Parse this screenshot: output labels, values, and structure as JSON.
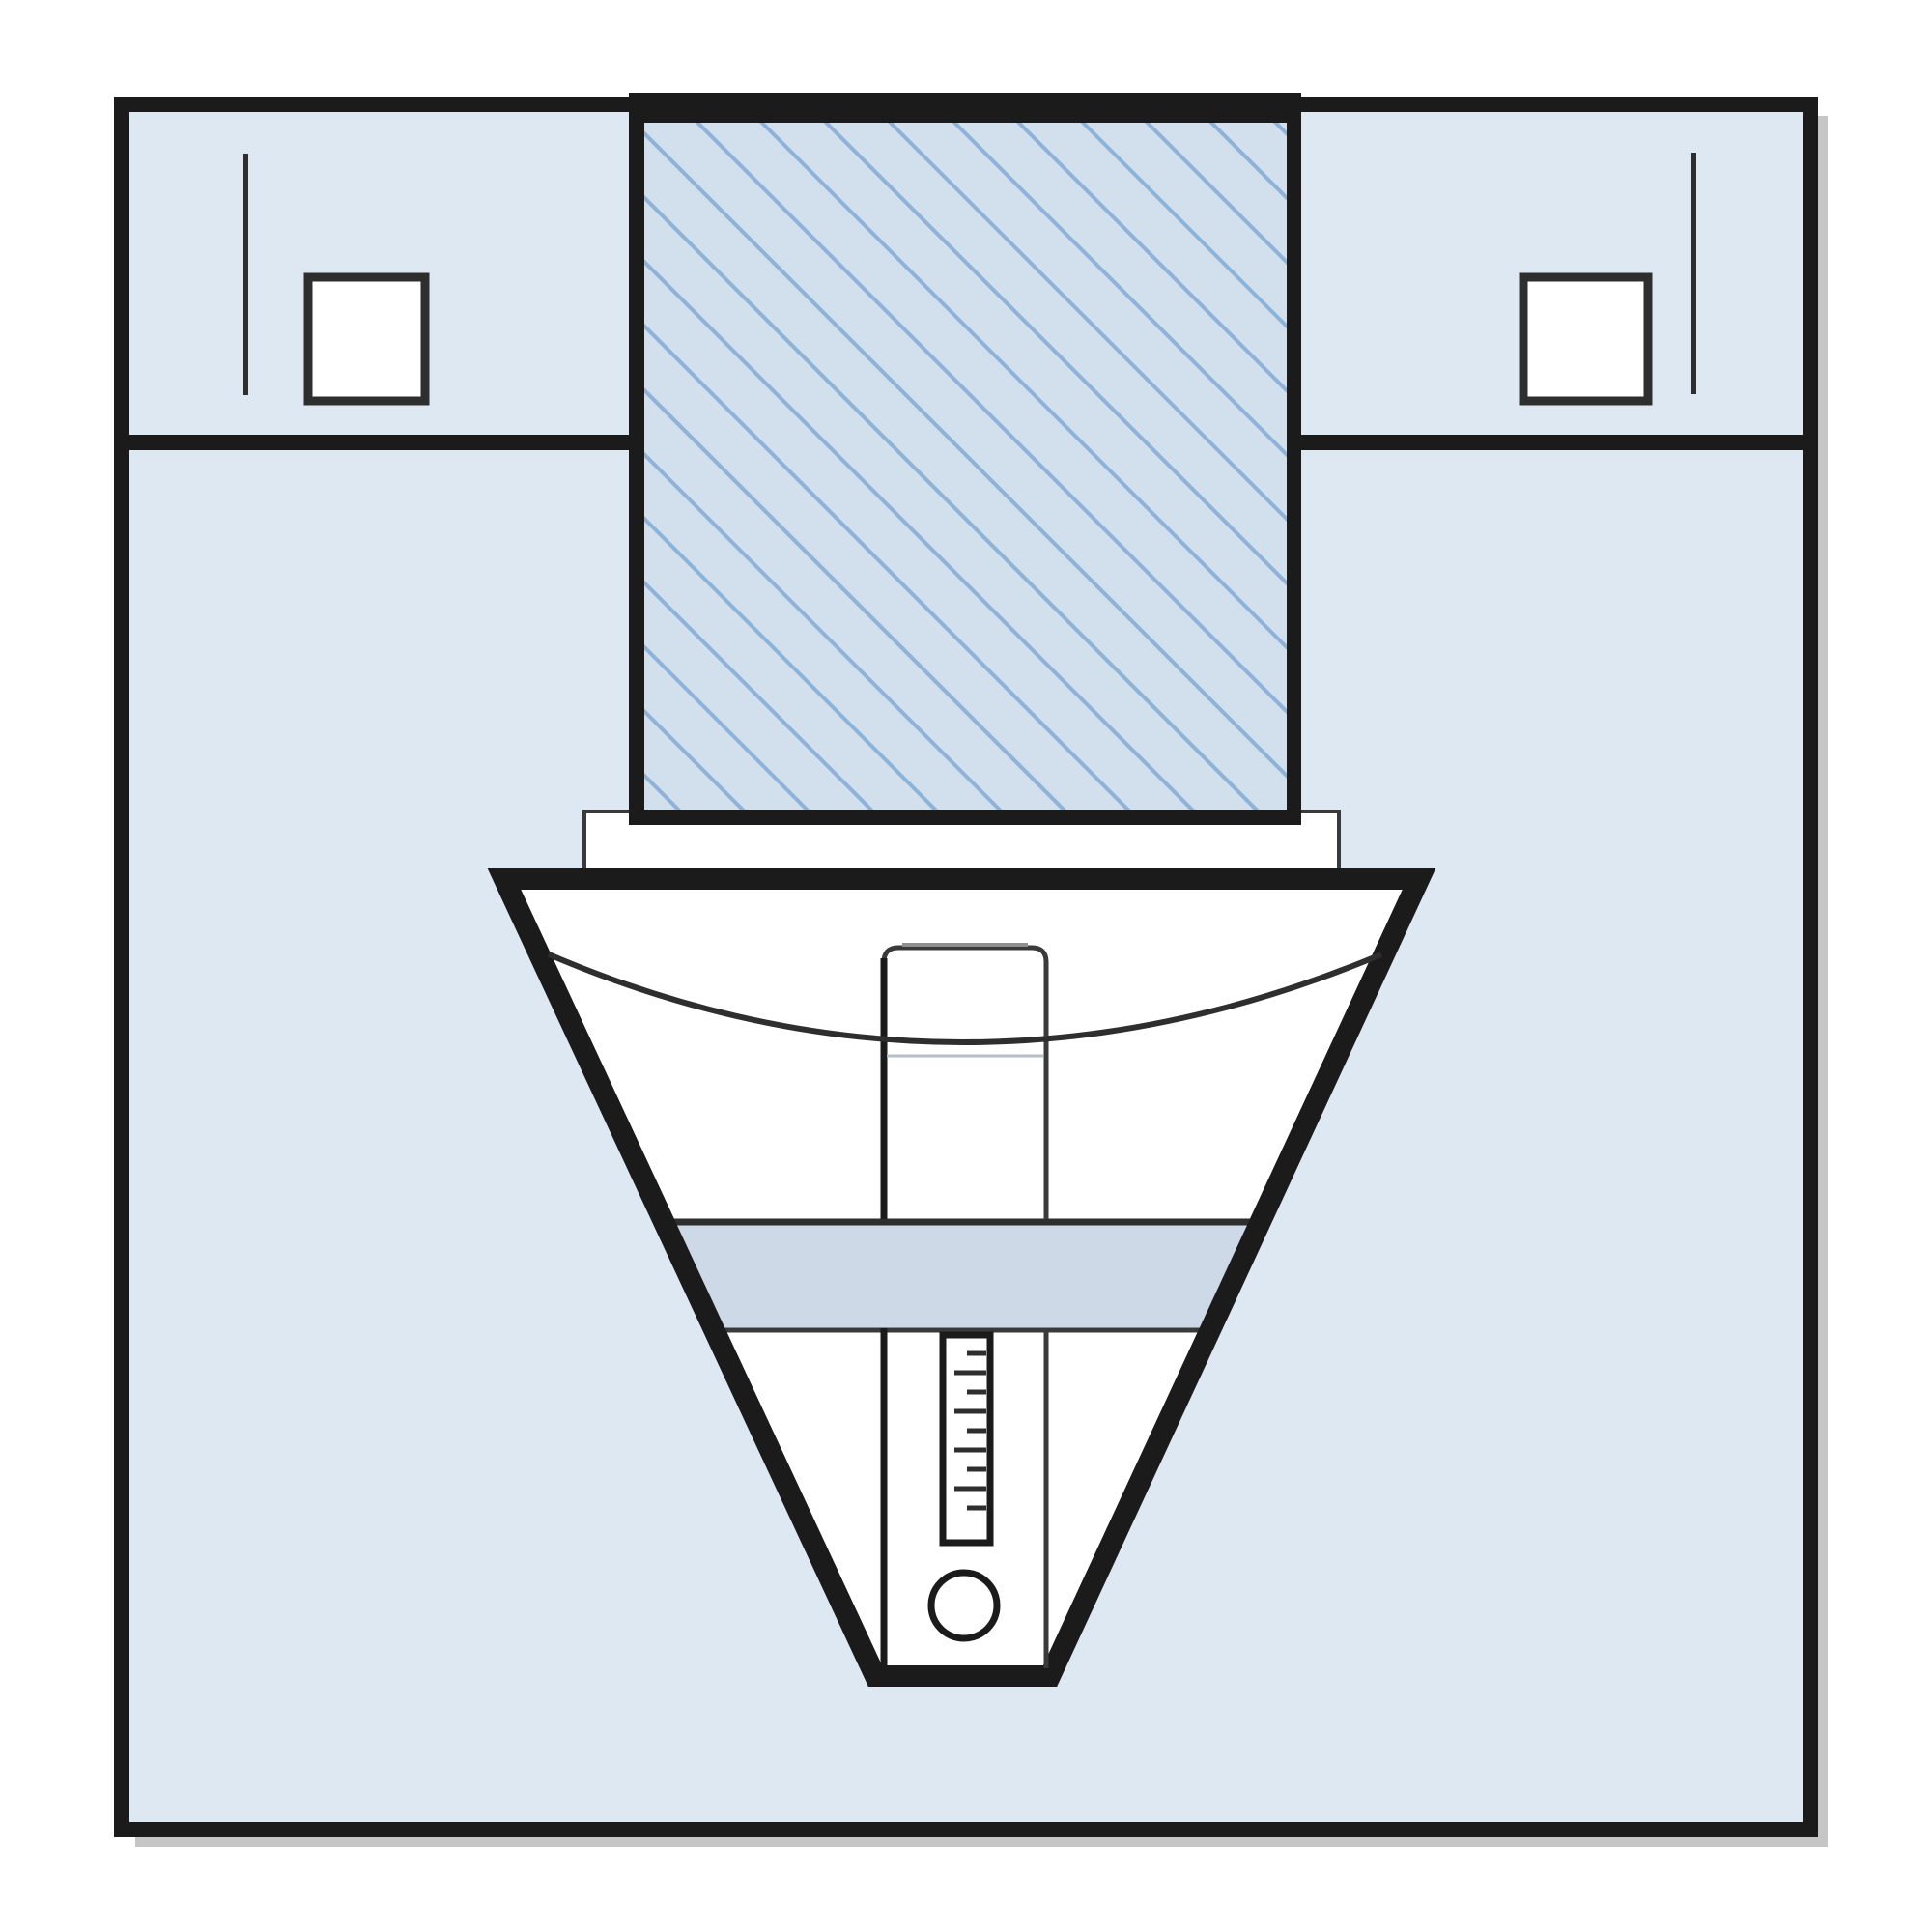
{
  "colors": {
    "page": "#ffffff",
    "ink": "#1b1b1b",
    "ink_soft": "#2e2e2e",
    "outline_gray": "#3a3a3a",
    "body": "#dde8f2",
    "hatch_bg": "#d2e0ee",
    "hatch_line": "#8fb2d8",
    "band": "#cdd9e6",
    "white": "#ffffff",
    "cap_gray": "#8f8f8f",
    "echo_gray": "#b7bec6",
    "shadow": "#c6c6c6"
  },
  "diagram": {
    "kind": "schematic line drawing, no text",
    "parts": [
      "outer square enclosure",
      "left upper compartment with small square and tick line",
      "right upper compartment with small square and tick line",
      "central hatched block",
      "collar plate under hatched block",
      "inverted funnel hopper",
      "concave level curve",
      "central feed channel",
      "horizontal filter band",
      "vertical gauge ruler with tick marks",
      "sight circle at spout"
    ]
  }
}
